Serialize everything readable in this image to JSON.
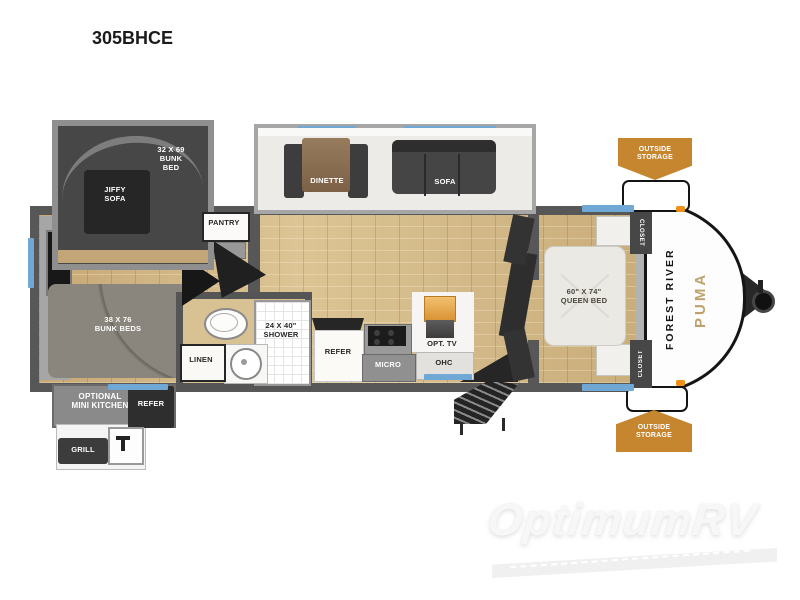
{
  "title": "305BHCE",
  "watermark": "OptimumRV",
  "floorplan": {
    "bunk_room": {
      "bunk_over_label": "32 X 69\nBUNK\nBED",
      "jiffy_sofa_label": "JIFFY\nSOFA",
      "bunk_beds_label": "38 X 76\nBUNK BEDS"
    },
    "hall": {
      "pantry_label": "PANTRY"
    },
    "bathroom": {
      "shower_label": "24 X 40\"\nSHOWER",
      "linen_label": "LINEN"
    },
    "living": {
      "dinette_label": "DINETTE",
      "sofa_label": "SOFA"
    },
    "kitchen": {
      "refer_label": "REFER",
      "micro_label": "MICRO",
      "ohc_label": "OHC",
      "opt_tv_label": "OPT. TV"
    },
    "bedroom": {
      "queen_bed_label": "60\" X 74\"\nQUEEN BED",
      "closet_top_label": "CLOSET",
      "closet_bottom_label": "CLOSET"
    },
    "exterior": {
      "outside_storage_top_label": "OUTSIDE\nSTORAGE",
      "outside_storage_bottom_label": "OUTSIDE\nSTORAGE",
      "optional_mini_kitchen_label": "OPTIONAL\nMINI KITCHEN",
      "refer_label": "REFER",
      "grill_label": "GRILL"
    },
    "front_cap": {
      "brand": "FOREST RIVER",
      "model": "PUMA"
    }
  },
  "colors": {
    "wall": "#575757",
    "floor_wood": "#cbae7d",
    "storage_banner": "#c5862f",
    "window": "#6fa8d4",
    "bed_white": "#ebe9e4",
    "tv_accent": "#e5a44c",
    "brand_gold": "#b3924f"
  }
}
